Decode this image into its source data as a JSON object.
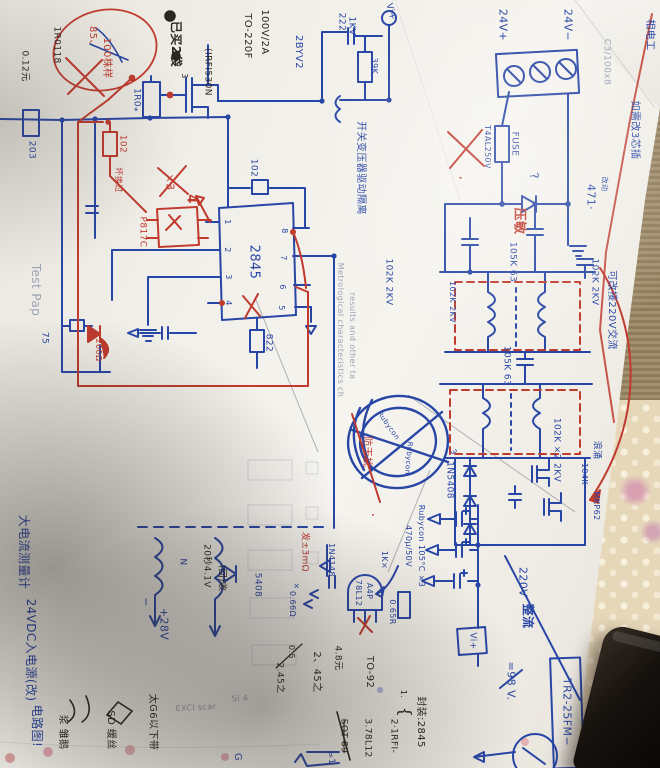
{
  "palette": {
    "blue": "#2846a6",
    "red": "#c03a2e",
    "black": "#2b2620",
    "print": "#9aa3b5"
  },
  "labels": [
    {
      "t": "24V+",
      "x": 503,
      "y": 25,
      "s": 11,
      "c": "blue"
    },
    {
      "t": "24V−",
      "x": 568,
      "y": 25,
      "s": 11,
      "c": "blue"
    },
    {
      "t": "FUSE",
      "x": 514,
      "y": 144,
      "s": 9,
      "c": "blue"
    },
    {
      "t": "T4AL250V",
      "x": 487,
      "y": 147,
      "s": 8,
      "c": "blue"
    },
    {
      "t": "?",
      "x": 534,
      "y": 176,
      "s": 12,
      "c": "blue",
      "r": 80
    },
    {
      "t": "压敏",
      "x": 519,
      "y": 221,
      "s": 13,
      "c": "red",
      "b": 1
    },
    {
      "t": "471·",
      "x": 591,
      "y": 197,
      "s": 11,
      "c": "blue"
    },
    {
      "t": "改动",
      "x": 604,
      "y": 184,
      "s": 7,
      "c": "blue"
    },
    {
      "t": "相电工",
      "x": 649,
      "y": 35,
      "s": 10,
      "c": "blue"
    },
    {
      "t": "如需改3芯插",
      "x": 634,
      "y": 130,
      "s": 10,
      "c": "blue"
    },
    {
      "t": "可改接220V交流",
      "x": 611,
      "y": 310,
      "s": 10,
      "c": "blue"
    },
    {
      "t": "102K 2KV",
      "x": 388,
      "y": 282,
      "s": 9,
      "c": "blue"
    },
    {
      "t": "102K 2KV",
      "x": 452,
      "y": 302,
      "s": 8,
      "c": "blue"
    },
    {
      "t": "105K 63",
      "x": 512,
      "y": 262,
      "s": 9,
      "c": "blue"
    },
    {
      "t": "102K 2KV",
      "x": 594,
      "y": 282,
      "s": 9,
      "c": "blue"
    },
    {
      "t": "105K 63",
      "x": 506,
      "y": 366,
      "s": 9,
      "c": "blue"
    },
    {
      "t": "102K ×2 2KV",
      "x": 556,
      "y": 450,
      "s": 9,
      "c": "blue"
    },
    {
      "t": "浪涌",
      "x": 596,
      "y": 450,
      "s": 9,
      "c": "blue"
    },
    {
      "t": "104K",
      "x": 584,
      "y": 474,
      "s": 8,
      "c": "blue"
    },
    {
      "t": "MKP62",
      "x": 596,
      "y": 506,
      "s": 8,
      "c": "blue"
    },
    {
      "t": "1N5408",
      "x": 449,
      "y": 480,
      "s": 9,
      "c": "blue"
    },
    {
      "t": "3",
      "x": 453,
      "y": 452,
      "s": 8,
      "c": "blue",
      "r": 70
    },
    {
      "t": "Rubycon",
      "x": 388,
      "y": 426,
      "s": 7,
      "c": "blue",
      "r": 55
    },
    {
      "t": "Rubycon",
      "x": 408,
      "y": 458,
      "s": 7,
      "c": "blue",
      "r": 95
    },
    {
      "t": "防干扰",
      "x": 366,
      "y": 452,
      "s": 10,
      "c": "red"
    },
    {
      "t": "·",
      "x": 372,
      "y": 515,
      "s": 14,
      "c": "red"
    },
    {
      "t": "开关变压器驱动隔离",
      "x": 360,
      "y": 168,
      "s": 10,
      "c": "blue"
    },
    {
      "t": "222",
      "x": 341,
      "y": 22,
      "s": 9,
      "c": "blue"
    },
    {
      "t": "1KV",
      "x": 351,
      "y": 26,
      "s": 9,
      "c": "blue"
    },
    {
      "t": "39K",
      "x": 374,
      "y": 66,
      "s": 8,
      "c": "blue"
    },
    {
      "t": "Vi+",
      "x": 390,
      "y": 12,
      "s": 9,
      "c": "blue",
      "r": 75
    },
    {
      "t": "2BYV2",
      "x": 298,
      "y": 52,
      "s": 10,
      "c": "blue"
    },
    {
      "t": "100V/2A",
      "x": 264,
      "y": 32,
      "s": 10,
      "c": "black"
    },
    {
      "t": "TO-220F",
      "x": 247,
      "y": 36,
      "s": 10,
      "c": "black"
    },
    {
      "t": "(IRFI530N",
      "x": 207,
      "y": 72,
      "s": 9,
      "c": "black"
    },
    {
      "t": "已买2袋",
      "x": 176,
      "y": 44,
      "s": 12,
      "c": "black",
      "b": 1
    },
    {
      "t": "3",
      "x": 184,
      "y": 76,
      "s": 8,
      "c": "black"
    },
    {
      "t": "1R0118",
      "x": 56,
      "y": 45,
      "s": 9,
      "c": "black"
    },
    {
      "t": "0.12元",
      "x": 24,
      "y": 66,
      "s": 9,
      "c": "black"
    },
    {
      "t": "85、",
      "x": 92,
      "y": 38,
      "s": 10,
      "c": "red"
    },
    {
      "t": "100株样",
      "x": 106,
      "y": 58,
      "s": 10,
      "c": "red"
    },
    {
      "t": "1R0⁎",
      "x": 136,
      "y": 100,
      "s": 9,
      "c": "blue"
    },
    {
      "t": "203",
      "x": 31,
      "y": 150,
      "s": 9,
      "c": "blue"
    },
    {
      "t": "102",
      "x": 122,
      "y": 144,
      "s": 9,
      "c": "red"
    },
    {
      "t": "坏换过",
      "x": 118,
      "y": 180,
      "s": 8,
      "c": "red"
    },
    {
      "t": "P817C",
      "x": 142,
      "y": 232,
      "s": 9,
      "c": "red"
    },
    {
      "t": "×3",
      "x": 170,
      "y": 182,
      "s": 11,
      "c": "red"
    },
    {
      "t": "4",
      "x": 191,
      "y": 199,
      "s": 13,
      "c": "red",
      "b": 1
    },
    {
      "t": "102",
      "x": 253,
      "y": 168,
      "s": 9,
      "c": "blue"
    },
    {
      "t": "2845",
      "x": 254,
      "y": 262,
      "s": 13,
      "c": "blue"
    },
    {
      "t": "1",
      "x": 227,
      "y": 222,
      "s": 8,
      "c": "blue"
    },
    {
      "t": "2",
      "x": 227,
      "y": 250,
      "s": 8,
      "c": "blue"
    },
    {
      "t": "3",
      "x": 228,
      "y": 277,
      "s": 8,
      "c": "blue"
    },
    {
      "t": "4",
      "x": 228,
      "y": 303,
      "s": 8,
      "c": "blue"
    },
    {
      "t": "8",
      "x": 284,
      "y": 231,
      "s": 8,
      "c": "blue"
    },
    {
      "t": "7",
      "x": 283,
      "y": 258,
      "s": 8,
      "c": "blue"
    },
    {
      "t": "6",
      "x": 282,
      "y": 287,
      "s": 8,
      "c": "blue"
    },
    {
      "t": "5",
      "x": 281,
      "y": 308,
      "s": 8,
      "c": "blue"
    },
    {
      "t": "822",
      "x": 268,
      "y": 343,
      "s": 9,
      "c": "blue"
    },
    {
      "t": "75",
      "x": 44,
      "y": 338,
      "s": 9,
      "c": "blue"
    },
    {
      "t": "200Ω",
      "x": 98,
      "y": 350,
      "s": 8,
      "c": "red"
    },
    {
      "t": "20秒4.1V",
      "x": 206,
      "y": 566,
      "s": 9,
      "c": "black"
    },
    {
      "t": "(回)收",
      "x": 221,
      "y": 578,
      "s": 9,
      "c": "black"
    },
    {
      "t": "大电流测量计",
      "x": 24,
      "y": 552,
      "s": 12,
      "c": "blue"
    },
    {
      "t": "24VDC入电源(改)",
      "x": 31,
      "y": 650,
      "s": 12,
      "c": "blue"
    },
    {
      "t": "电路图!",
      "x": 37,
      "y": 726,
      "s": 12,
      "c": "blue"
    },
    {
      "t": "5408",
      "x": 257,
      "y": 585,
      "s": 9,
      "c": "blue"
    },
    {
      "t": "N",
      "x": 182,
      "y": 562,
      "s": 9,
      "c": "blue"
    },
    {
      "t": "+28V",
      "x": 164,
      "y": 624,
      "s": 11,
      "c": "blue"
    },
    {
      "t": "−",
      "x": 146,
      "y": 602,
      "s": 11,
      "c": "blue"
    },
    {
      "t": "发±3mΩ",
      "x": 304,
      "y": 552,
      "s": 9,
      "c": "red"
    },
    {
      "t": "1N4148",
      "x": 331,
      "y": 560,
      "s": 8,
      "c": "blue"
    },
    {
      "t": "0.66Ω",
      "x": 292,
      "y": 604,
      "s": 8,
      "c": "blue"
    },
    {
      "t": "×",
      "x": 296,
      "y": 586,
      "s": 8,
      "c": "blue"
    },
    {
      "t": "1K×",
      "x": 384,
      "y": 560,
      "s": 8,
      "c": "blue"
    },
    {
      "t": "78L12",
      "x": 358,
      "y": 593,
      "s": 8,
      "c": "blue"
    },
    {
      "t": "A4P",
      "x": 369,
      "y": 591,
      "s": 8,
      "c": "blue"
    },
    {
      "t": "0.65R",
      "x": 392,
      "y": 612,
      "s": 8,
      "c": "blue"
    },
    {
      "t": "Rubycon 105°C ×3",
      "x": 421,
      "y": 546,
      "s": 8,
      "c": "blue"
    },
    {
      "t": "470μ/50V",
      "x": 408,
      "y": 546,
      "s": 8,
      "c": "blue"
    },
    {
      "t": "Vi+",
      "x": 472,
      "y": 641,
      "s": 9,
      "c": "blue"
    },
    {
      "t": "220V",
      "x": 523,
      "y": 582,
      "s": 11,
      "c": "blue"
    },
    {
      "t": "整流",
      "x": 528,
      "y": 616,
      "s": 12,
      "c": "blue",
      "b": 1
    },
    {
      "t": "=98 V.",
      "x": 511,
      "y": 681,
      "s": 11,
      "c": "blue"
    },
    {
      "t": "TR2-25FM−",
      "x": 567,
      "y": 712,
      "s": 11,
      "c": "blue"
    },
    {
      "t": "封装:2845",
      "x": 420,
      "y": 722,
      "s": 10,
      "c": "black"
    },
    {
      "t": "{",
      "x": 405,
      "y": 712,
      "s": 16,
      "c": "black"
    },
    {
      "t": "1.",
      "x": 403,
      "y": 694,
      "s": 8,
      "c": "black"
    },
    {
      "t": "2·1RFI-",
      "x": 393,
      "y": 736,
      "s": 9,
      "c": "black"
    },
    {
      "t": "TO-92",
      "x": 369,
      "y": 672,
      "s": 10,
      "c": "black"
    },
    {
      "t": "3.78L12",
      "x": 367,
      "y": 738,
      "s": 9,
      "c": "black"
    },
    {
      "t": "4.8元",
      "x": 337,
      "y": 658,
      "s": 9,
      "c": "black"
    },
    {
      "t": "SOT-89",
      "x": 343,
      "y": 736,
      "s": 9,
      "c": "black",
      "strike": 1
    },
    {
      "t": "2、45之",
      "x": 316,
      "y": 672,
      "s": 10,
      "c": "black"
    },
    {
      "t": "0.5",
      "x": 291,
      "y": 652,
      "s": 8,
      "c": "black"
    },
    {
      "t": "2.45之",
      "x": 279,
      "y": 678,
      "s": 9,
      "c": "black"
    },
    {
      "t": "太G6以下带",
      "x": 152,
      "y": 722,
      "s": 10,
      "c": "black"
    },
    {
      "t": "SD 缓丝",
      "x": 110,
      "y": 730,
      "s": 10,
      "c": "black"
    },
    {
      "t": "浆 雏鹅",
      "x": 62,
      "y": 732,
      "s": 10,
      "c": "black"
    },
    {
      "t": "G",
      "x": 237,
      "y": 757,
      "s": 10,
      "c": "blue"
    },
    {
      "t": "=1",
      "x": 330,
      "y": 758,
      "s": 9,
      "c": "blue",
      "r": 80
    },
    {
      "t": "·",
      "x": 460,
      "y": 178,
      "s": 16,
      "c": "red"
    },
    {
      "t": "Test Pap",
      "x": 36,
      "y": 290,
      "s": 12,
      "c": "print"
    },
    {
      "t": "Metrological characteristics ch",
      "x": 340,
      "y": 330,
      "s": 8,
      "c": "print"
    },
    {
      "t": "results and other ta",
      "x": 352,
      "y": 336,
      "s": 8,
      "c": "print"
    },
    {
      "t": "C3/100x8",
      "x": 606,
      "y": 62,
      "s": 9,
      "c": "print"
    },
    {
      "t": "EXCI scar",
      "x": 196,
      "y": 708,
      "s": 8,
      "c": "print",
      "r": -3
    },
    {
      "t": "Si 4",
      "x": 240,
      "y": 699,
      "s": 8,
      "c": "print",
      "r": -3
    }
  ]
}
